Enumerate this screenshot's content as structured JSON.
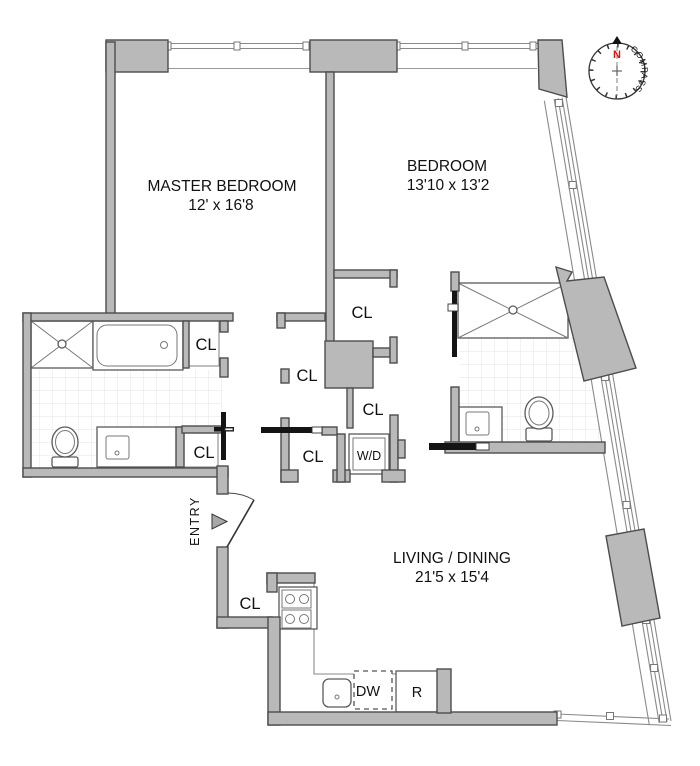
{
  "rooms": {
    "master_bedroom": {
      "name": "MASTER BEDROOM",
      "dims": "12' x 16'8"
    },
    "bedroom": {
      "name": "BEDROOM",
      "dims": "13'10 x 13'2"
    },
    "living_dining": {
      "name": "LIVING / DINING",
      "dims": "21'5 x 15'4"
    }
  },
  "labels": {
    "closet": "CL",
    "washer_dryer": "W/D",
    "dishwasher": "DW",
    "refrigerator": "R",
    "entry": "ENTRY"
  },
  "compass": {
    "north": "N",
    "label": "COMPASS"
  },
  "colors": {
    "bg": "#ffffff",
    "wall": "#b9b9b9",
    "wall-border": "#4d4d4d",
    "line": "#8a8a8a",
    "tile": "#e4e4e4",
    "dark": "#141414",
    "north": "#e01010",
    "text": "#111111"
  }
}
